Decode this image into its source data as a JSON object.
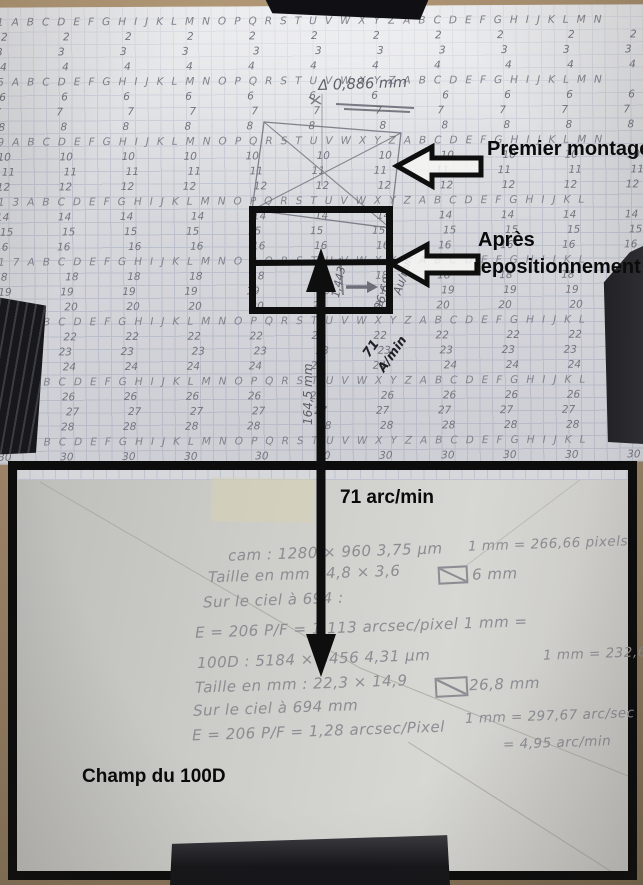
{
  "photo": {
    "labels": {
      "premier_montage": "Premier montage",
      "apres_line1": "Après",
      "apres_line2": "repositionnement",
      "arrow_scale": "71 arc/min",
      "champ_100d": "Champ du 100D"
    },
    "pencil_notes": {
      "delta": "Δ 0,886 mm",
      "small_ratio": "1,443",
      "diag_value": "96,68",
      "diag_unit": "Au/min",
      "marker_line1": "71",
      "marker_line2": "A/min",
      "arrow_length": "164,5 mm"
    },
    "grid_paper": {
      "alphabet": "ABCDEFGHIJKLMNOPQRSTUVWXYZ",
      "row_count": 30,
      "letter_rows": [
        1,
        5,
        9,
        13,
        17,
        21,
        25,
        29
      ],
      "number_columns": 11
    },
    "calc_sheet": {
      "webcam": {
        "spec": "cam : 1280 × 960    3,75 µm",
        "scale": "1 mm = 266,66 pixels",
        "size": "Taille en mm : 4,8 × 3,6",
        "diagonal": "6 mm",
        "sky": "Sur le ciel à 694 :",
        "sampling": "E = 206 P/F = 1,113 arcsec/pixel    1 mm ="
      },
      "d100": {
        "spec": "100D : 5184 × 3456    4,31 µm",
        "scale": "1 mm = 232,66 pixels",
        "size": "Taille en mm : 22,3 × 14,9",
        "diagonal": "26,8 mm",
        "sky": "Sur le ciel à 694 mm",
        "sampling": "E = 206 P/F = 1,28 arcsec/Pixel",
        "mm_arcsec": "1 mm = 297,67 arc/sec",
        "mm_arcmin": "= 4,95 arc/min"
      }
    },
    "colors": {
      "ink": "#0e0e0e",
      "pencil": "#7b7b85",
      "grid_paper": "#d9dade",
      "calc_paper": "#cdcdc9",
      "background": "#a2876a"
    }
  }
}
